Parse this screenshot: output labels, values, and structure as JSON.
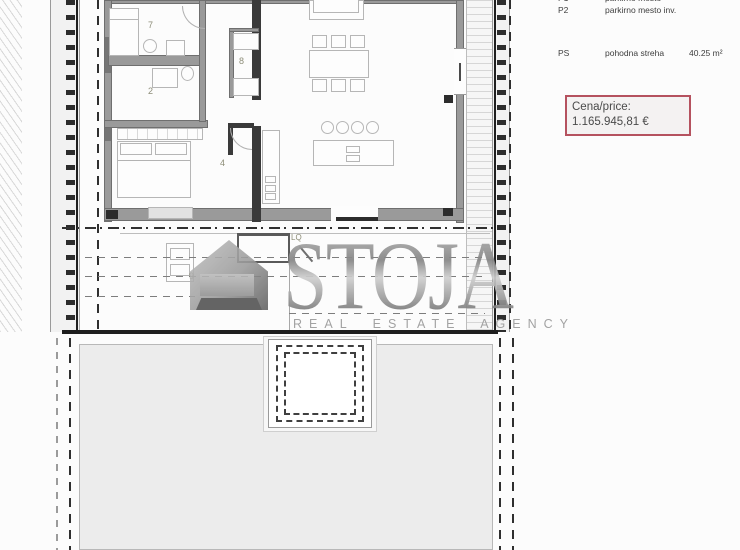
{
  "side_panel": {
    "parking": [
      {
        "code": "P1",
        "desc": "parkirno mesto"
      },
      {
        "code": "P2",
        "desc": "parkirno mesto inv."
      }
    ],
    "roof": {
      "code": "PS",
      "desc": "pohodna streha",
      "area": "40.25 m²"
    },
    "price": {
      "label": "Cena/price:",
      "value": "1.165.945,81 €"
    }
  },
  "watermark": {
    "name": "STOJA",
    "tagline": "REAL ESTATE AGENCY"
  },
  "plan": {
    "room_labels": [
      {
        "text": "7"
      },
      {
        "text": "2"
      },
      {
        "text": "8"
      },
      {
        "text": "4"
      },
      {
        "text": "9"
      },
      {
        "text": "LQ"
      }
    ]
  },
  "colors": {
    "price_border": "#b5525f",
    "watermark_gray": "#8c8c8c",
    "terrace_fill": "#ececec",
    "label_olive": "#8d8d78",
    "dark_wall": "#3a3a3a"
  }
}
